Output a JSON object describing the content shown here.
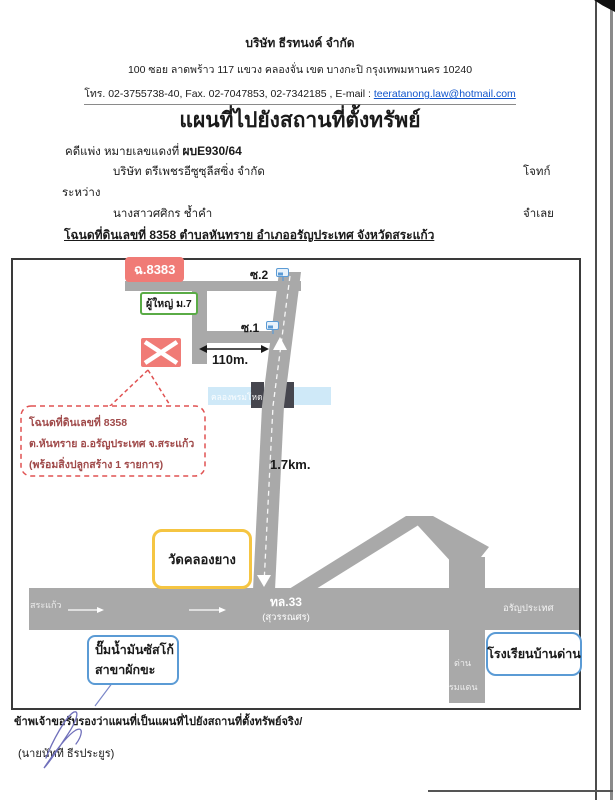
{
  "header": {
    "company": "บริษัท  ธีรทนงค์ จำกัด",
    "address": "100  ซอย ลาดพร้าว 117   แขวง คลองจั่น   เขต บางกะปิ  กรุงเทพมหานคร  10240",
    "contact_prefix": "โทร. 02-3755738-40, Fax. 02-7047853, 02-7342185 , E-mail : ",
    "email": "teeratanong.law@hotmail.com"
  },
  "title": "แผนที่ไปยังสถานที่ตั้งทรัพย์",
  "case": {
    "label_prefix": "คดีแพ่ง หมายเลขแดงที่ ",
    "case_no": "ผบE930/64",
    "plaintiff": "บริษัท ตรีเพชรอีซูซุลีสซิ่ง จำกัด",
    "plaintiff_role": "โจทก์",
    "between": "ระหว่าง",
    "defendant": "นางสาวศศิกร ช้ำคำ",
    "defendant_role": "จำเลย",
    "deed_line": "โฉนดที่ดินเลขที่ 8358  ตำบลหันทราย  อำเภออรัญประเทศ  จังหวัดสระแก้ว"
  },
  "map": {
    "deed_badge": "ฉ.8383",
    "village_head": "ผู้ใหญ่ ม.7",
    "soi2": "ซ.2",
    "soi1": "ซ.1",
    "distance_soi": "110m.",
    "distance_main": "1.7km.",
    "canal": "คลองพรมโหด",
    "bubble_line1": "โฉนดที่ดินเลขที่ 8358",
    "bubble_line2": "ต.หันทราย  อ.อรัญประเทศ  จ.สระแก้ว",
    "bubble_line3": "(พร้อมสิ่งปลูกสร้าง 1 รายการ)",
    "temple": "วัดคลองยาง",
    "highway_name": "ทล.33",
    "highway_sub": "(สุวรรณศร)",
    "west_label": "สระแก้ว",
    "east_label": "อรัญประเทศ",
    "south_label_1": "ด่าน",
    "south_label_2": "พรมแดน",
    "gas_line1": "ปั๊มน้ำมันซัสโก้",
    "gas_line2": "สาขาผักขะ",
    "school": "โรงเรียนบ้านด่าน"
  },
  "footer": {
    "certify": "ข้าพเจ้าขอรับรองว่าแผนที่เป็นแผนที่ไปยังสถานที่ตั้งทรัพย์จริง/",
    "signer": "(นายนัทที  ธีรประยูร)"
  },
  "colors": {
    "road": "#a9a9a9",
    "canal": "#cfe9f8",
    "property_red": "#f07b76",
    "green_border": "#5aab46",
    "yellow_border": "#f5c542",
    "blue_border": "#5b9bd5",
    "bubble_red": "#e05252",
    "bridge_dark": "#46464e"
  }
}
